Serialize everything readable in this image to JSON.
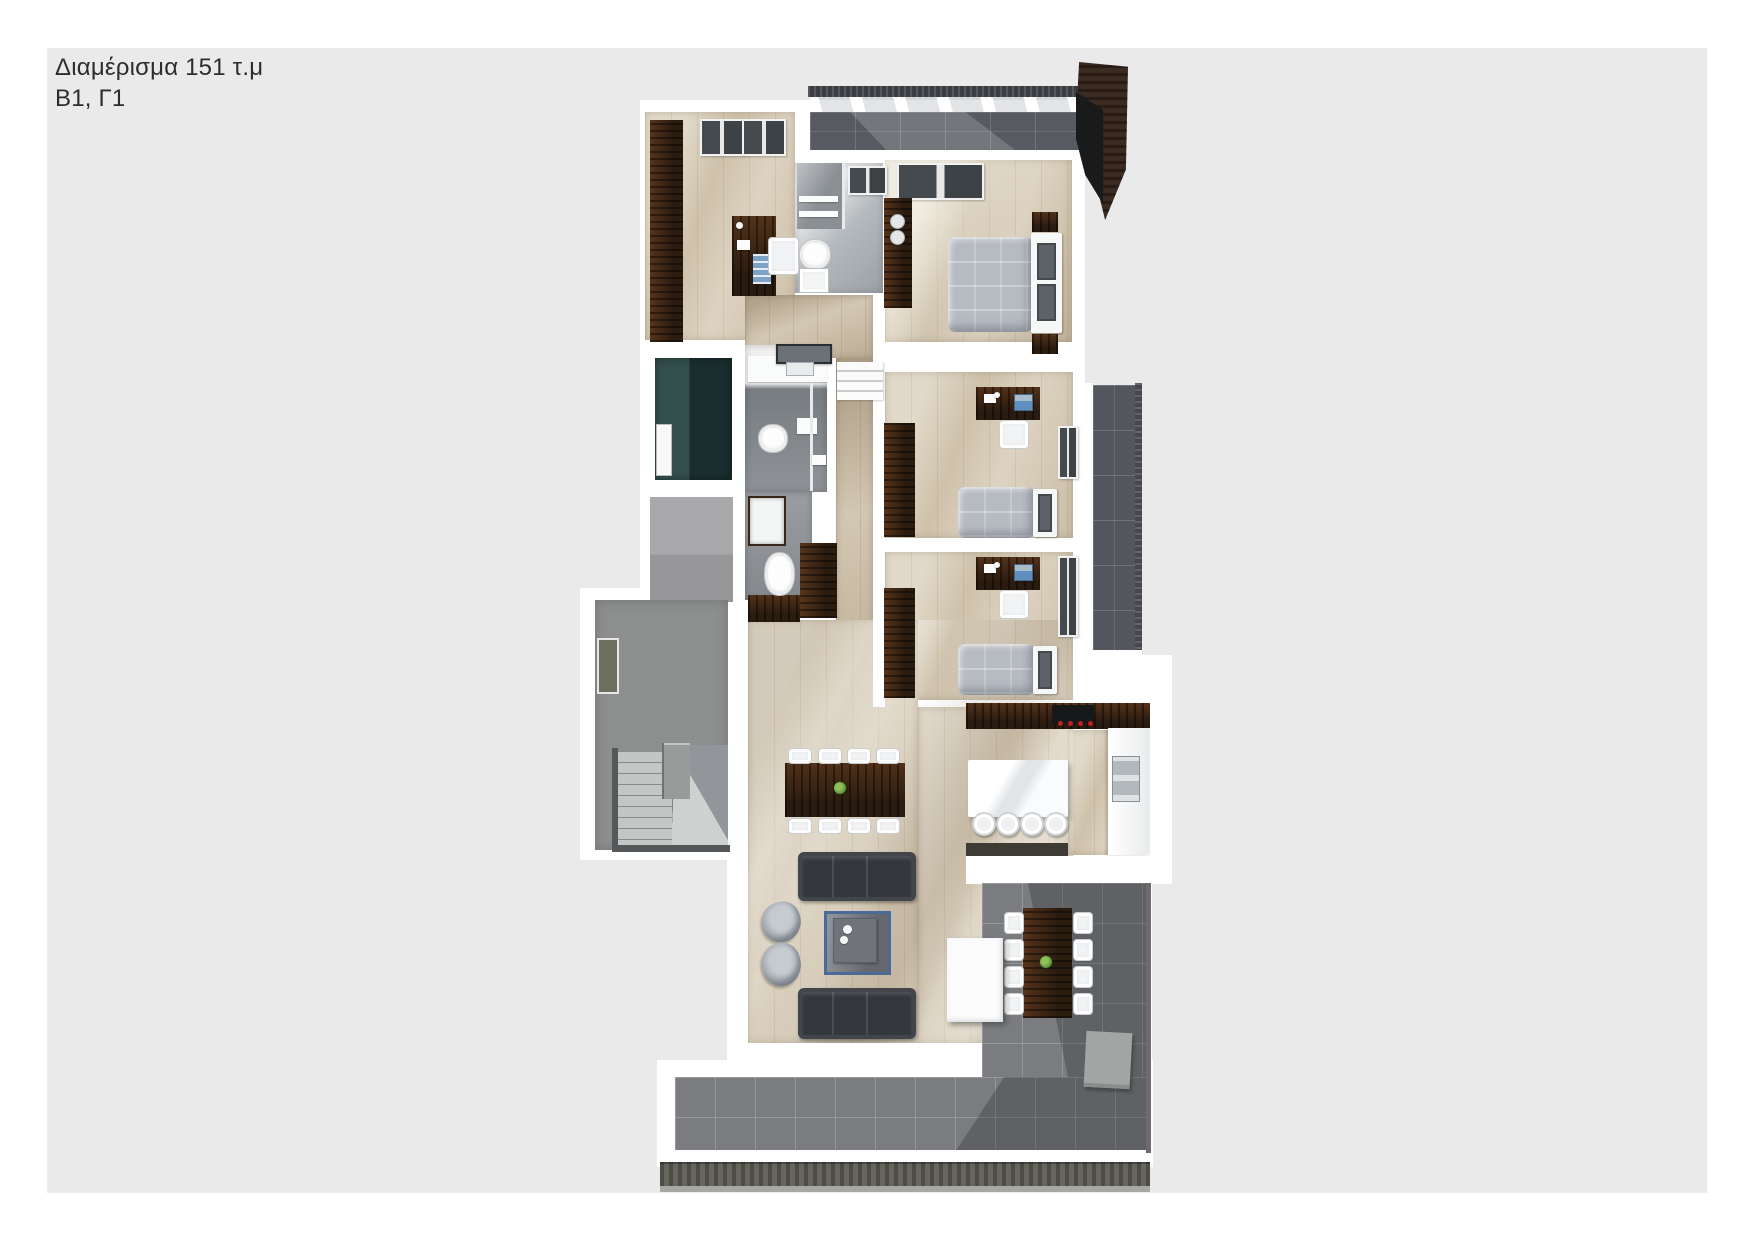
{
  "header": {
    "title": "Διαμέρισμα 151 τ.μ",
    "subtitle": "Β1, Γ1",
    "text_color": "#2d2d2f"
  },
  "page": {
    "outer_background": "#ffffff",
    "panel_background": "#eaeaeb"
  },
  "palette": {
    "wall_white": "#ffffff",
    "floor_wood": "#d5c9b3",
    "floor_wood_corridor": "#c9bba2",
    "balcony_tile_dark": "#575b61",
    "terrace_tile": "#7a7c80",
    "terrace_front_edge": "#67665e",
    "dark_wood_furniture": "#3a2516",
    "fabric_gray_bed": "#b6bac1",
    "sofa_charcoal": "#42464b",
    "rug_blue_border": "#4a6b99",
    "glass_dark": "#41464b",
    "teal_shaft_wall": "#33504d",
    "roof_gray": "#a9a9ab",
    "stair_gray": "#8d8f8e",
    "plant_green": "#5c8f3e",
    "cooktop_knob_red": "#c02020"
  },
  "plan_areas": [
    "office",
    "bathroom-ensuite",
    "master-bedroom",
    "hallway",
    "bathroom-main",
    "wc",
    "corridor",
    "bedroom-2",
    "bedroom-3",
    "stairwell",
    "elevator-shaft",
    "living-room",
    "dining-area",
    "kitchen",
    "top-balcony",
    "side-balcony",
    "terrace"
  ]
}
